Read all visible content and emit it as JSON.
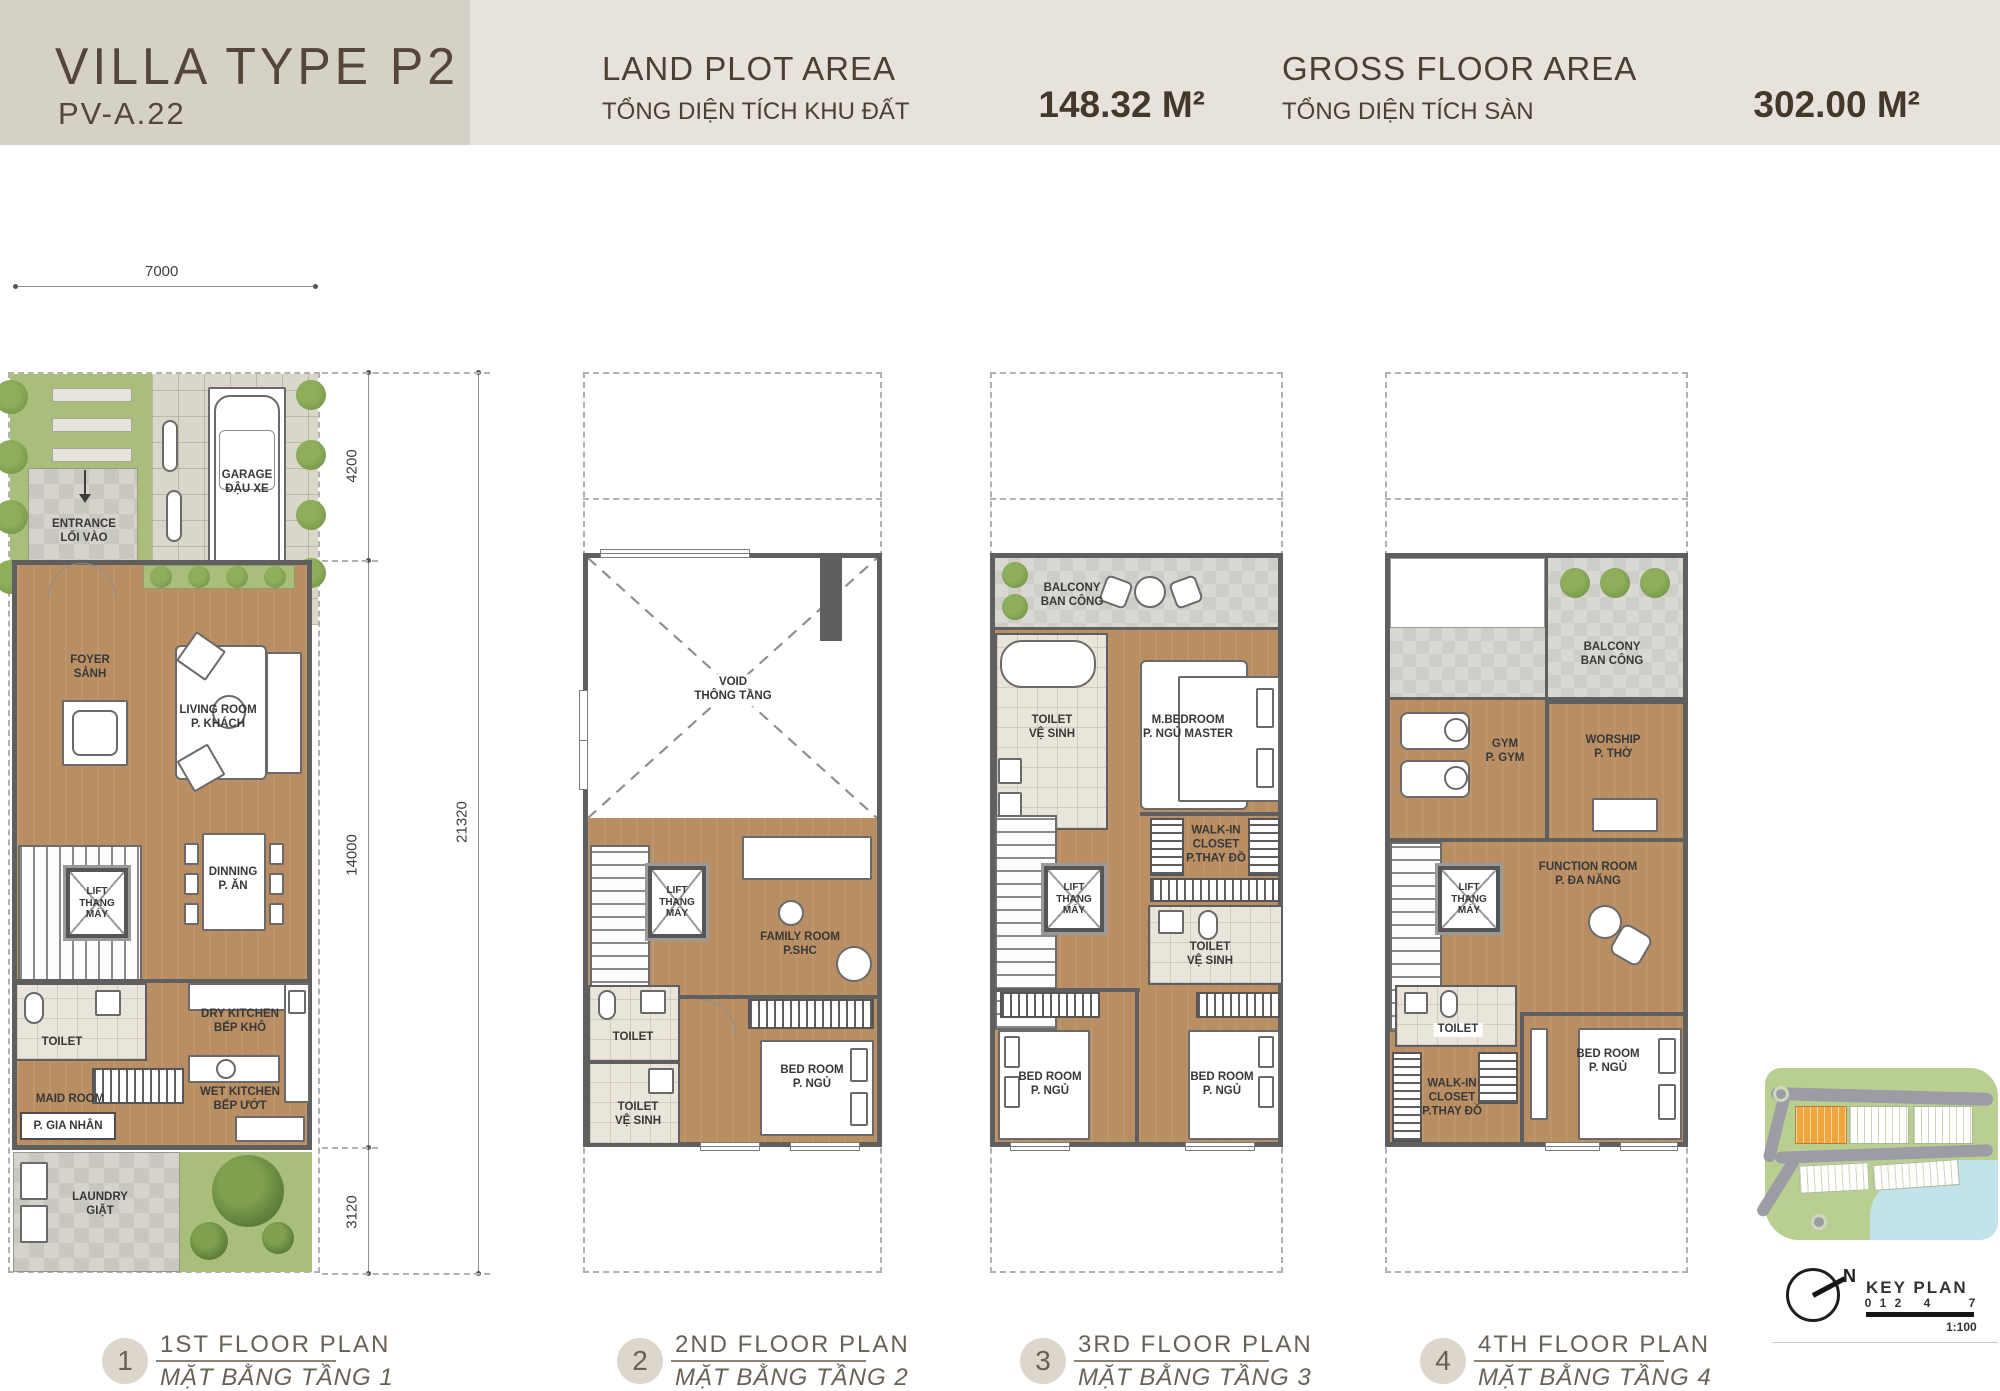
{
  "header": {
    "title": "VILLA TYPE P2",
    "code": "PV-A.22",
    "land_plot": {
      "title": "LAND PLOT AREA",
      "subtitle": "TỔNG DIỆN TÍCH KHU ĐẤT",
      "value": "148.32 M²"
    },
    "gross_floor": {
      "title": "GROSS FLOOR AREA",
      "subtitle": "TỔNG DIỆN TÍCH SÀN",
      "value": "302.00 M²"
    }
  },
  "dimensions": {
    "lot_width": "7000",
    "front": "4200",
    "middle": "14000",
    "rear": "3120",
    "total": "21320"
  },
  "floor1": {
    "garage": {
      "en": "GARAGE",
      "vi": "ĐẬU XE"
    },
    "entrance": {
      "en": "ENTRANCE",
      "vi": "LỐI VÀO"
    },
    "foyer": {
      "en": "FOYER",
      "vi": "SẢNH"
    },
    "living": {
      "en": "LIVING ROOM",
      "vi": "P. KHÁCH"
    },
    "lift": {
      "en": "LIFT",
      "vi": "THANG MÁY"
    },
    "dining": {
      "en": "DINNING",
      "vi": "P. ĂN"
    },
    "toilet": {
      "en": "TOILET"
    },
    "maid": {
      "en": "MAID ROOM",
      "vi": "P. GIA NHÂN"
    },
    "dry_kitchen": {
      "en": "DRY KITCHEN",
      "vi": "BẾP KHÔ"
    },
    "wet_kitchen": {
      "en": "WET KITCHEN",
      "vi": "BẾP ƯỚT"
    },
    "laundry": {
      "en": "LAUNDRY",
      "vi": "GIẶT"
    }
  },
  "floor2": {
    "void": {
      "en": "VOID",
      "vi": "THÔNG TẦNG"
    },
    "lift": {
      "en": "LIFT",
      "vi": "THANG MÁY"
    },
    "family": {
      "en": "FAMILY ROOM",
      "vi": "P.SHC"
    },
    "toilet1": {
      "en": "TOILET"
    },
    "toilet2": {
      "en": "TOILET",
      "vi": "VỆ SINH"
    },
    "bedroom": {
      "en": "BED ROOM",
      "vi": "P. NGỦ"
    }
  },
  "floor3": {
    "balcony": {
      "en": "BALCONY",
      "vi": "BAN CÔNG"
    },
    "toilet_master": {
      "en": "TOILET",
      "vi": "VỆ SINH"
    },
    "master_bedroom": {
      "en": "M.BEDROOM",
      "vi": "P. NGỦ MASTER"
    },
    "walkin": {
      "en": "WALK-IN CLOSET",
      "vi": "P.THAY ĐỒ"
    },
    "lift": {
      "en": "LIFT",
      "vi": "THANG MÁY"
    },
    "toilet": {
      "en": "TOILET",
      "vi": "VỆ SINH"
    },
    "bedroom_left": {
      "en": "BED ROOM",
      "vi": "P. NGỦ"
    },
    "bedroom_right": {
      "en": "BED ROOM",
      "vi": "P. NGỦ"
    }
  },
  "floor4": {
    "balcony": {
      "en": "BALCONY",
      "vi": "BAN CÔNG"
    },
    "gym": {
      "en": "GYM",
      "vi": "P. GYM"
    },
    "worship": {
      "en": "WORSHIP",
      "vi": "P. THỜ"
    },
    "lift": {
      "en": "LIFT",
      "vi": "THANG MÁY"
    },
    "function": {
      "en": "FUNCTION ROOM",
      "vi": "P. ĐA NĂNG"
    },
    "toilet": {
      "en": "TOILET"
    },
    "walkin": {
      "en": "WALK-IN CLOSET",
      "vi": "P.THAY ĐỒ"
    },
    "bedroom": {
      "en": "BED ROOM",
      "vi": "P. NGỦ"
    }
  },
  "captions": [
    {
      "num": "1",
      "en": "1ST FLOOR PLAN",
      "vi": "MẶT BẰNG TẦNG 1"
    },
    {
      "num": "2",
      "en": "2ND FLOOR PLAN",
      "vi": "MẶT BẰNG TẦNG 2"
    },
    {
      "num": "3",
      "en": "3RD FLOOR PLAN",
      "vi": "MẶT BẰNG TẦNG 3"
    },
    {
      "num": "4",
      "en": "4TH FLOOR PLAN",
      "vi": "MẶT BẰNG TẦNG 4"
    }
  ],
  "key_plan": {
    "label": "KEY PLAN",
    "north": "N",
    "scale_ticks": [
      "0",
      "1",
      "2",
      "4",
      "7"
    ],
    "scale_ratio": "1:100"
  },
  "colors": {
    "header_bg": "#d6d1c6",
    "header_bg_light": "#e7e3dc",
    "text_brown": "#4c4034",
    "wood": "#b98e63",
    "tile": "#eae5da",
    "balcony": "#d9d8d3",
    "grass": "#aabe7b",
    "wall": "#5f5f5f",
    "water": "#c2e2ec",
    "road": "#9c9ca4",
    "lot_highlight": "#f0a63d"
  }
}
